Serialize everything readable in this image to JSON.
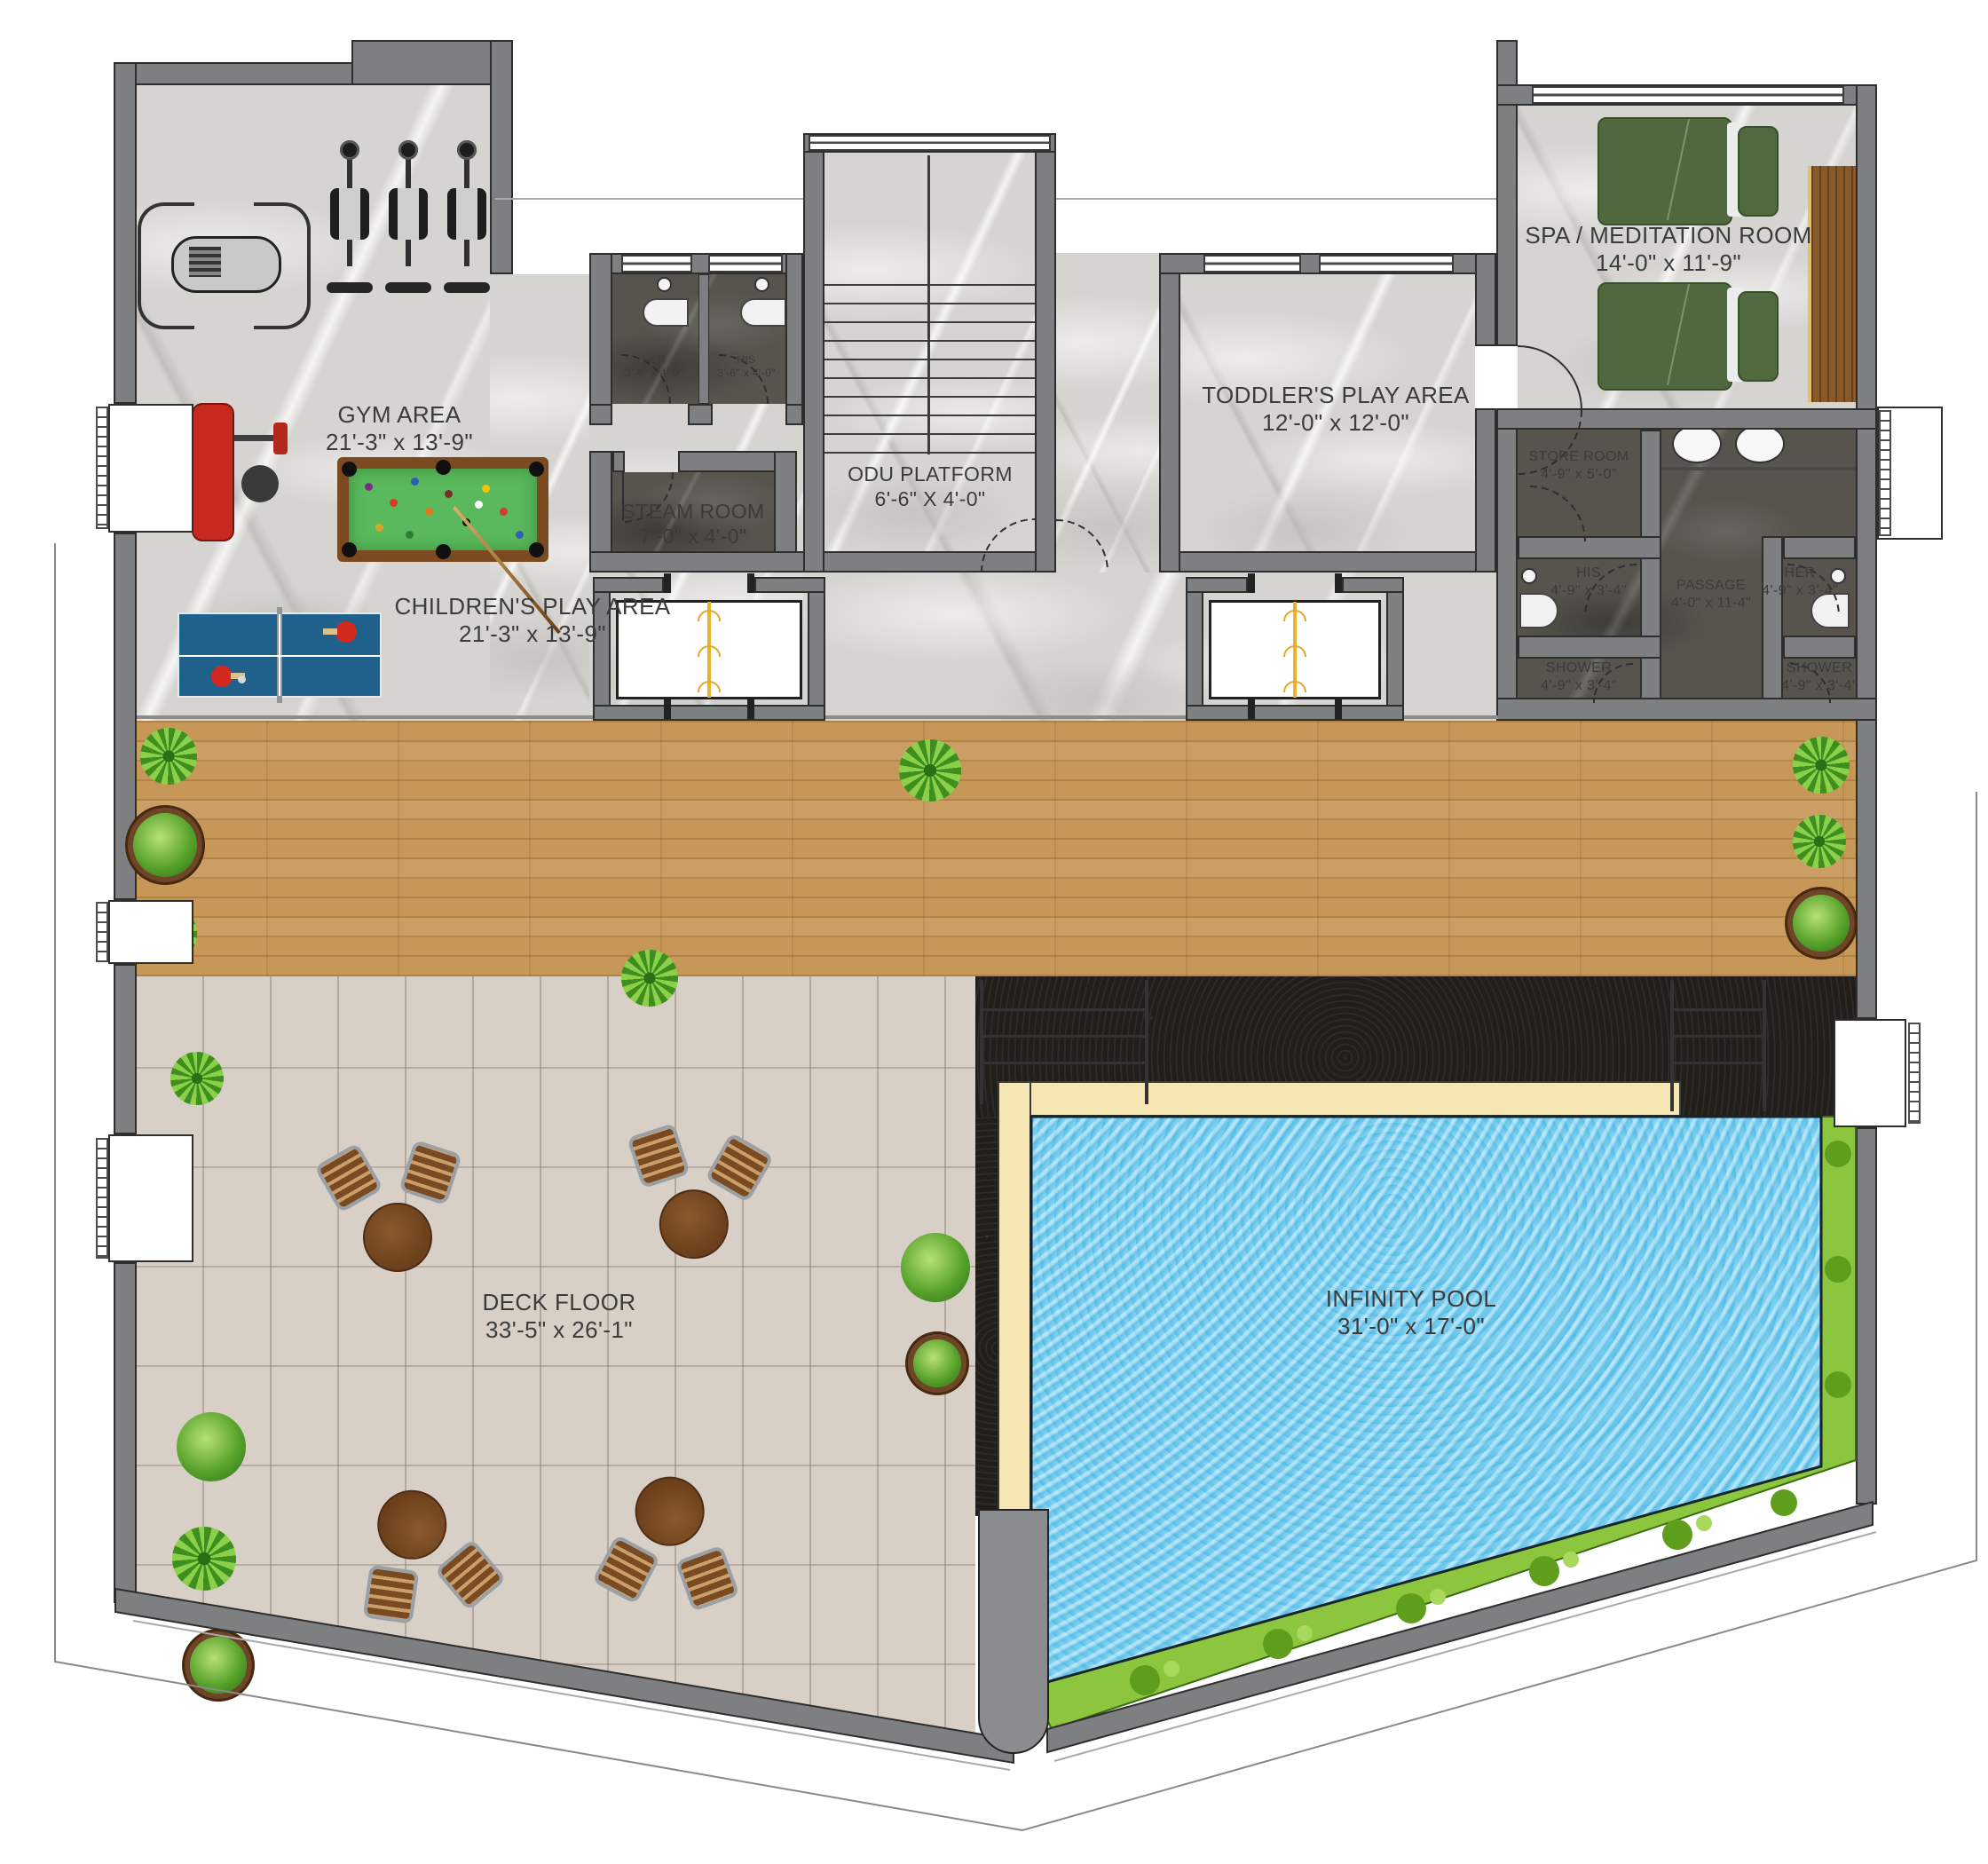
{
  "rooms": {
    "gym": {
      "name": "GYM AREA",
      "dims": "21'-3\" x 13'-9\""
    },
    "children": {
      "name": "CHILDREN'S PLAY AREA",
      "dims": "21'-3\" x 13'-9\""
    },
    "her_top": {
      "name": "HER",
      "dims": "3'-6\" x 4'-0\""
    },
    "his_top": {
      "name": "HIS",
      "dims": "3'-6\" x 4'-0\""
    },
    "steam": {
      "name": "STEAM ROOM",
      "dims": "7'-0\" x 4'-0\""
    },
    "odu": {
      "name": "ODU PLATFORM",
      "dims": "6'-6\" X 4'-0\""
    },
    "toddler": {
      "name": "TODDLER'S PLAY AREA",
      "dims": "12'-0\" x 12'-0\""
    },
    "spa": {
      "name": "SPA / MEDITATION ROOM",
      "dims": "14'-0\" x 11'-9\""
    },
    "store": {
      "name": "STORE ROOM",
      "dims": "4'-9\" x 5'-0\""
    },
    "his_mid": {
      "name": "HIS",
      "dims": "4'-9\" x 3'-4\""
    },
    "her_mid": {
      "name": "HER",
      "dims": "4'-9\" x 3'-4\""
    },
    "passage": {
      "name": "PASSAGE",
      "dims": "4'-0\" x 11-4\""
    },
    "shower_l": {
      "name": "SHOWER",
      "dims": "4'-9\" x 3'-4\""
    },
    "shower_r": {
      "name": "SHOWER",
      "dims": "4'-9\" x 3'-4\""
    },
    "deck": {
      "name": "DECK FLOOR",
      "dims": "33'-5\" x 26'-1\""
    },
    "pool": {
      "name": "INFINITY POOL",
      "dims": "31'-0\" x 17'-0\""
    }
  },
  "icons": {
    "pool-table": "billiards table with balls and cue",
    "ping-pong-table": "table tennis table with paddles",
    "cardio-machine": "exercise machine",
    "bench-press": "red weight bench",
    "cable-machine": "cable crossover machine",
    "spa-bed": "massage bed",
    "dining-set": "round table with two chairs",
    "plant": "potted plant",
    "elevator": "lift cab",
    "staircase": "stair flight",
    "sink": "wash basin",
    "toilet": "water closet",
    "balcony-railing": "railing squares"
  },
  "colors": {
    "wall": "#7d7f81",
    "marble": "#d6d4d1",
    "dark": "#56544d",
    "wood": "#c79758",
    "tile": "#d8cfc7",
    "granite": "#211e1a",
    "coping": "#f6e6b4",
    "water": "#57c1ea",
    "grass": "#8cc63e",
    "felt": "#59b95c",
    "tablewood": "#7b4a21",
    "tt": "#20618c",
    "bed": "#50683e",
    "red": "#c62a1f"
  }
}
